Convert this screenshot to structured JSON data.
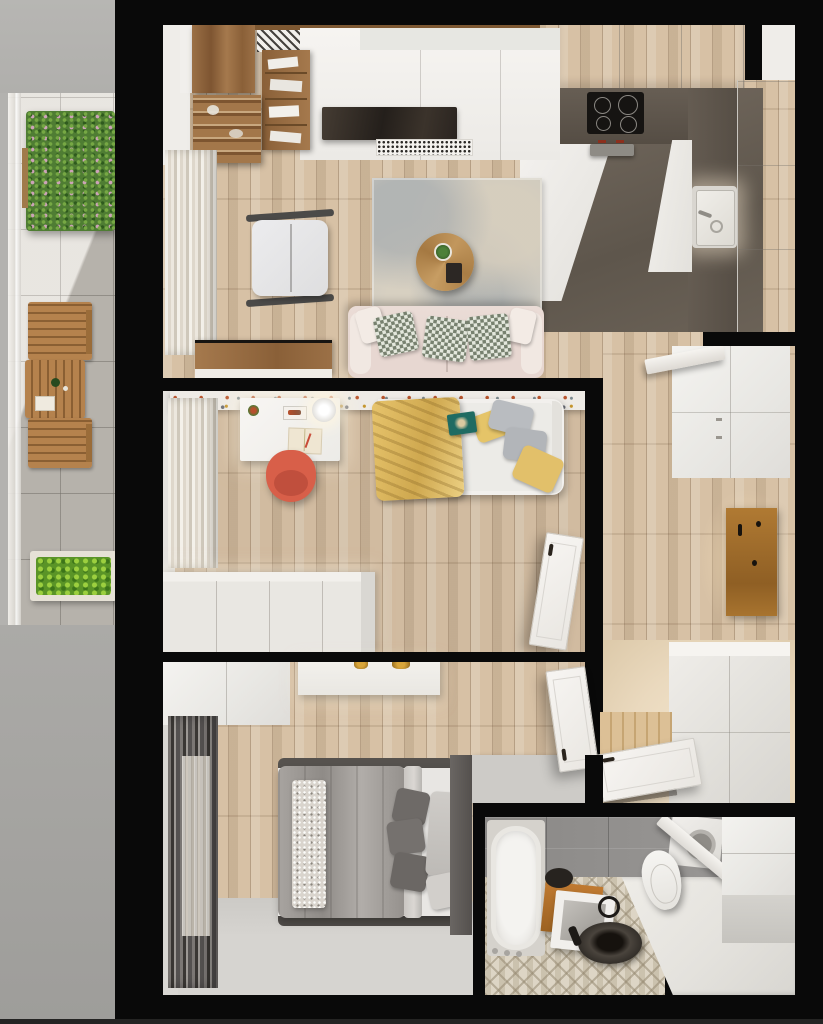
{
  "scene": {
    "type": "3d-floor-plan-render",
    "description": "Top-down 3D render of a one-bedroom apartment with balcony, living room with open kitchen, office/guest room, bedroom, hallway and bathroom",
    "rooms": [
      {
        "name": "balcony",
        "furniture": [
          "flowering planter",
          "wooden bistro table",
          "two wooden folding chairs",
          "leafy planter box",
          "glass railing",
          "stone tile floor"
        ]
      },
      {
        "name": "living-room",
        "furniture": [
          "walnut wardrobe",
          "open shelving unit",
          "bookshelf column",
          "white media wall",
          "tv",
          "speaker grille",
          "radiator grille",
          "armchair",
          "area rug",
          "round coffee table with plant",
          "blush sofa with checkered pillows",
          "walnut sideboard",
          "sheer curtains"
        ]
      },
      {
        "name": "kitchen",
        "furniture": [
          "upper cabinet row",
          "dark L-shaped countertop",
          "induction cooktop",
          "inset sink with faucet",
          "tall cabinet column",
          "dark stone floor"
        ]
      },
      {
        "name": "office-guest-room",
        "furniture": [
          "white desk",
          "desk lamp",
          "notebook",
          "coral desk chair",
          "single bed",
          "mustard throw blanket",
          "gray and yellow pillows",
          "teal book",
          "low white dresser",
          "terrazzo wall strip",
          "white door"
        ]
      },
      {
        "name": "hallway",
        "furniture": [
          "tall white wardrobe",
          "wall shelf",
          "wooden coat panel with hooks",
          "white shoe cabinet",
          "open white door",
          "wood plank floor"
        ]
      },
      {
        "name": "bedroom",
        "furniture": [
          "double bed",
          "gray duvet",
          "sparkly runner",
          "dark gray pillows",
          "white wardrobe",
          "console with gold decor",
          "dark curtains with sheers",
          "gray carpet",
          "dark headboard partition",
          "white door"
        ]
      },
      {
        "name": "bathroom",
        "furniture": [
          "bathtub",
          "toilet",
          "black round vessel sink",
          "black faucet",
          "leaning framed mirror",
          "wooden crate",
          "washing machine",
          "white wall cabinets",
          "mosaic triangle floor",
          "gray wall tiles"
        ]
      }
    ]
  },
  "palette": {
    "wall": "#090909",
    "outside-top": "#b5b4b1",
    "outside-bottom": "#a5a4a1",
    "wood-mid": "#d7c1a5",
    "balcony-tile": "#e0dcd5",
    "teak": "#b5824d",
    "teak-dark": "#8a5f33",
    "walnut": "#96693e",
    "white-furn": "#f2f0ed",
    "white-side": "#dcdad5",
    "offwhite-wall": "#efede9",
    "counter-dark": "#5b534a",
    "kitchen-floor": "#6c6359",
    "cooktop": "#161412",
    "sofa-blush": "#e7d7d1",
    "pillow-sage": "#77816f",
    "rug-base": "#cbc8bf",
    "chair-red": "#d85f49",
    "blanket-yellow": "#dfbd67",
    "pillow-gray": "#b9bcc0",
    "book-teal": "#1f6b62",
    "duvet-gray": "#9d9995",
    "pillow-dark": "#6e6a67",
    "headboard-dark": "#56524e",
    "partition-light": "#cdcbc7",
    "carpet-gray": "#d4d2ce",
    "tile-gray": "#908e8c",
    "platform-white": "#eae8e3",
    "sink-dark": "#2e2a25",
    "wood-crate": "#b5712e",
    "entry-beige": "#ead9be",
    "carpet-bed": "#d6d4d0"
  }
}
